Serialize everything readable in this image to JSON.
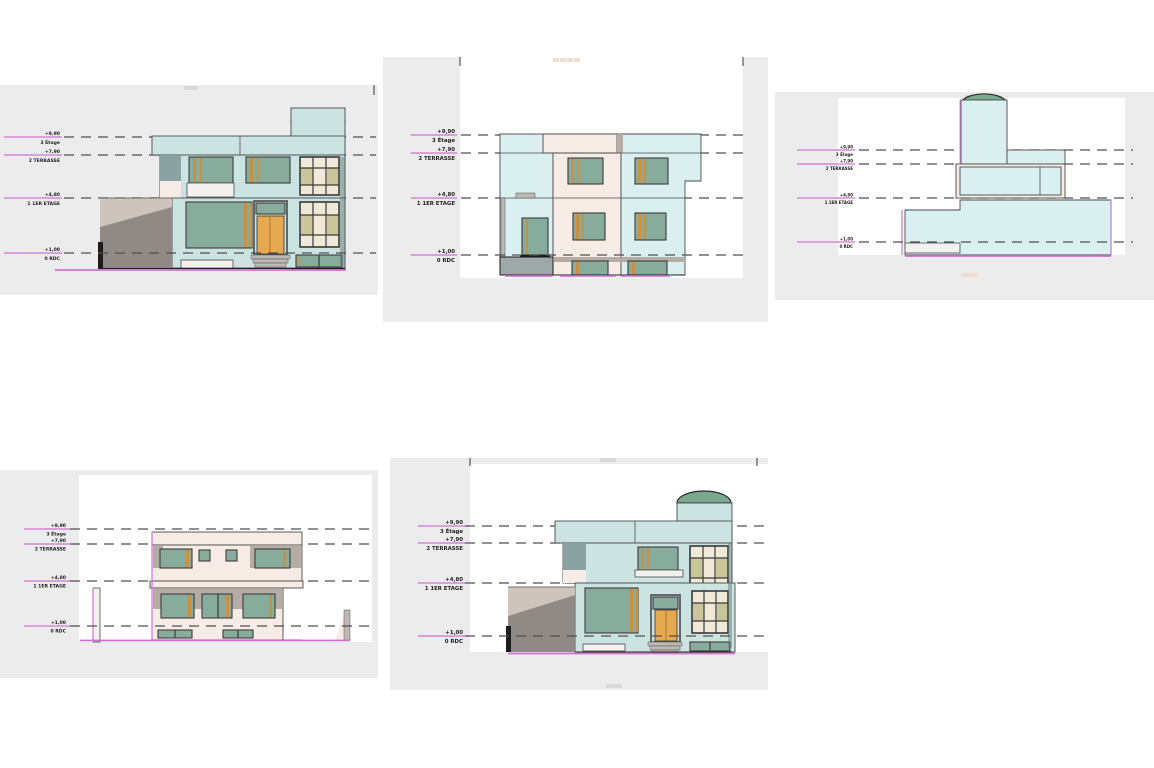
{
  "canvas": {
    "width": 1154,
    "height": 768
  },
  "colors": {
    "paper": "#ffffff",
    "sheet": "#ececec",
    "outline": "#4a4a4a",
    "dash": "#4f4f4f",
    "magenta": "#cf72d2",
    "violet": "#b48ad8",
    "teal": "#cbe4e2",
    "cyan": "#d9eff0",
    "cream": "#f6ece5",
    "glass": "#87ac9c",
    "frame_orange": "#c99140",
    "door_orange": "#e7a94f",
    "dome": "#7aa98c",
    "slate": "#8aa3a2",
    "taupe": "#cdc5bb",
    "taupe_dark": "#8f8a85",
    "pane_cream": "#f0e9d8",
    "pane_olive": "#c9c79a",
    "recess_gray": "#b5aca6",
    "base_gray": "#9fa8a8",
    "white_trim": "#f3f1ed",
    "step": "#bdb9b3",
    "shade": "#5f706c",
    "tick": "#333333",
    "text": "#222222"
  },
  "views": [
    {
      "levels": [
        {
          "value": "+9,90",
          "label": "3 Étage"
        },
        {
          "value": "+7,90",
          "label": "2 TERRASSE"
        },
        {
          "value": "+4,80",
          "label": "1 1ER ETAGE"
        },
        {
          "value": "+1,00",
          "label": "0 RDC"
        }
      ]
    },
    {
      "levels": [
        {
          "value": "+9,90",
          "label": "3 Étage"
        },
        {
          "value": "+7,90",
          "label": "2 TERRASSE"
        },
        {
          "value": "+4,80",
          "label": "1 1ER ETAGE"
        },
        {
          "value": "+1,00",
          "label": "0 RDC"
        }
      ]
    },
    {
      "levels": [
        {
          "value": "+9,90",
          "label": "3 Étage"
        },
        {
          "value": "+7,90",
          "label": "2 TERRASSE"
        },
        {
          "value": "+4,80",
          "label": "1 1ER ETAGE"
        },
        {
          "value": "+1,00",
          "label": "0 RDC"
        }
      ]
    },
    {
      "levels": [
        {
          "value": "+9,90",
          "label": "3 Étage"
        },
        {
          "value": "+7,90",
          "label": "2 TERRASSE"
        },
        {
          "value": "+4,80",
          "label": "1 1ER ETAGE"
        },
        {
          "value": "+1,00",
          "label": "0 RDC"
        }
      ]
    },
    {
      "levels": [
        {
          "value": "+9,90",
          "label": "3 Étage"
        },
        {
          "value": "+7,90",
          "label": "2 TERRASSE"
        },
        {
          "value": "+4,80",
          "label": "1 1ER ETAGE"
        },
        {
          "value": "+1,00",
          "label": "0 RDC"
        }
      ]
    }
  ]
}
